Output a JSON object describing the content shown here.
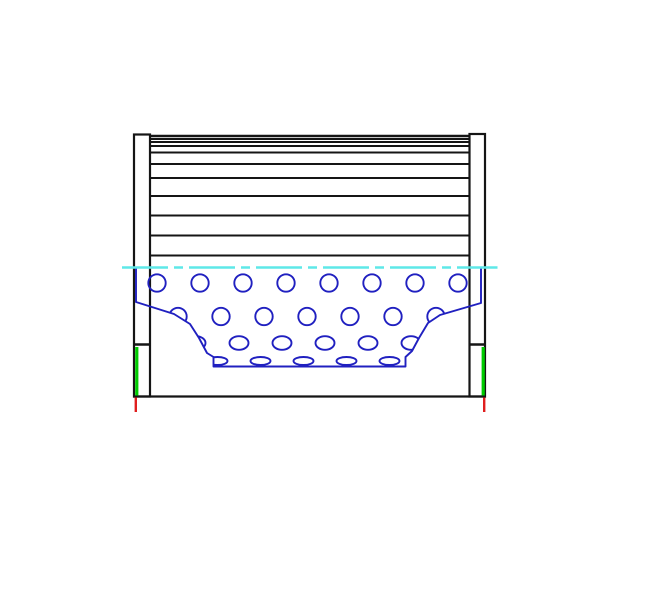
{
  "canvas": {
    "width": 668,
    "height": 616,
    "background": "#ffffff"
  },
  "colors": {
    "outline_black": "#151515",
    "core_blue": "#2020c0",
    "centerline_cyan": "#5ee8e8",
    "seal_green": "#00cc00",
    "datum_red": "#e01e1e"
  },
  "drawing": {
    "pleats": {
      "x1": 150,
      "x2": 469.5,
      "line_ys": [
        136,
        139,
        142,
        146,
        152.5,
        164,
        178,
        196,
        215.5,
        235.5,
        255.5
      ],
      "stroke_width": 1.9
    },
    "caps": {
      "left": {
        "x": 134,
        "y": 134.5,
        "w": 16,
        "h": 262,
        "divider_y": 344.5,
        "seal": {
          "x": 136.8,
          "y1": 347,
          "y2": 395.5
        },
        "datum": {
          "x": 135.8,
          "y1": 397.5,
          "y2": 412
        }
      },
      "right": {
        "x": 469.5,
        "y": 134,
        "w": 15.5,
        "h": 262.5,
        "divider_y": 344.5,
        "seal": {
          "x": 483.2,
          "y1": 347,
          "y2": 395.5
        },
        "datum": {
          "x": 484.2,
          "y1": 397.5,
          "y2": 412
        }
      }
    },
    "bottom_edge": {
      "x1": 133,
      "x2": 486,
      "y": 396.5,
      "stroke_width": 2.2
    },
    "centerline": {
      "x1": 122,
      "x2": 497.5,
      "y": 267.5,
      "dash": "46 6 9 6",
      "stroke_width": 2.4
    },
    "core": {
      "boundary_path": "M136,268 L136,302 L174,314 L190,324 L199,338 L207,353 L213.5,357 L213.5,366.5 L405.5,366.5 L405.5,357 L412,351 L419,338 L428,323 L440,315 L481,303 L481,268",
      "stroke_width": 1.9,
      "hole_rows": [
        {
          "cy": 283,
          "rx": 8.7,
          "ry": 8.7,
          "cx_start": 157,
          "step": 43,
          "count": 8
        },
        {
          "cy": 316.5,
          "rx": 8.7,
          "ry": 8.7,
          "cx_start": 178,
          "step": 43,
          "count": 7
        },
        {
          "cy": 343,
          "rx": 9.5,
          "ry": 6.8,
          "cx_start": 196,
          "step": 43,
          "count": 6
        },
        {
          "cy": 361,
          "rx": 10,
          "ry": 4,
          "cx_start": 217.5,
          "step": 43,
          "count": 5
        }
      ]
    }
  }
}
